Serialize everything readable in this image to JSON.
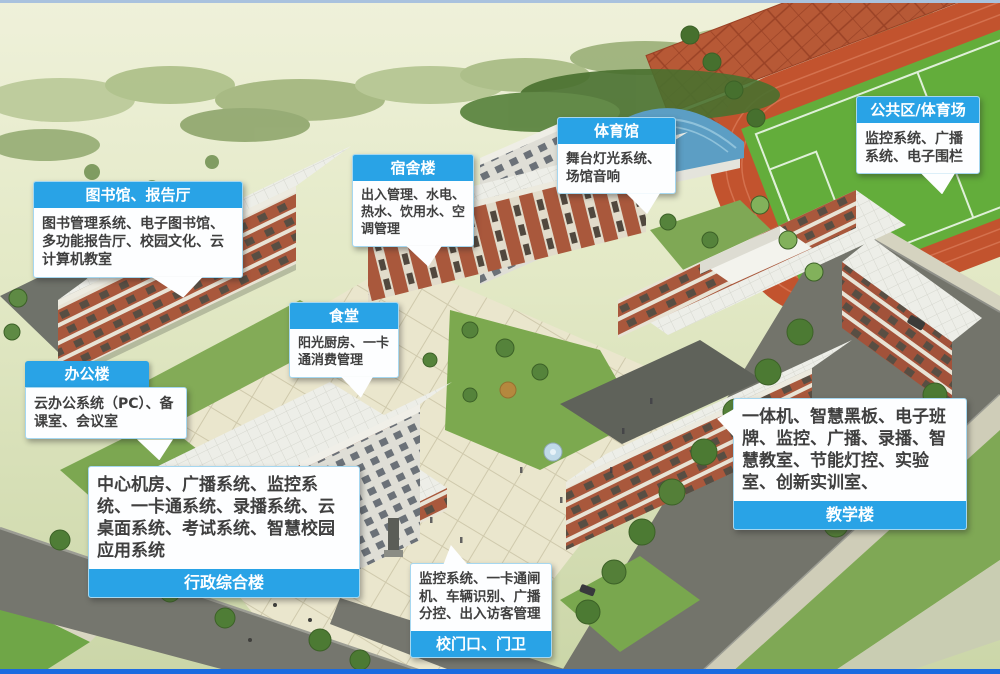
{
  "colors": {
    "callout_header": "#29A3E6",
    "callout_border": "#A5D7F0",
    "callout_body_bg": "#FDFEFF",
    "callout_text": "#3F3F3F",
    "top_line": "#A9C2DE",
    "bottom_line": "#1B6BE0"
  },
  "callouts": [
    {
      "id": "library",
      "title": "图书馆、报告厅",
      "body": "图书管理系统、电子图书馆、多功能报告厅、校园文化、云计算机教室"
    },
    {
      "id": "dormitory",
      "title": "宿舍楼",
      "body": "出入管理、水电、热水、饮用水、空调管理"
    },
    {
      "id": "gymnasium",
      "title": "体育馆",
      "body": "舞台灯光系统、场馆音响"
    },
    {
      "id": "public-stadium",
      "title": "公共区/体育场",
      "body": "监控系统、广播系统、电子围栏"
    },
    {
      "id": "canteen",
      "title": "食堂",
      "body": "阳光厨房、一卡通消费管理"
    },
    {
      "id": "office",
      "title": "办公楼",
      "body": "云办公系统（PC）、备课室、会议室"
    },
    {
      "id": "admin-complex",
      "title": "行政综合楼",
      "body": "中心机房、广播系统、监控系统、一卡通系统、录播系统、云桌面系统、考试系统、智慧校园应用系统"
    },
    {
      "id": "teaching",
      "title": "教学楼",
      "body": "一体机、智慧黑板、电子班牌、监控、广播、录播、智慧教室、节能灯控、实验室、创新实训室、"
    },
    {
      "id": "school-gate",
      "title": "校门口、门卫",
      "body": "监控系统、一卡通闸机、车辆识别、广播分控、出入访客管理"
    }
  ]
}
